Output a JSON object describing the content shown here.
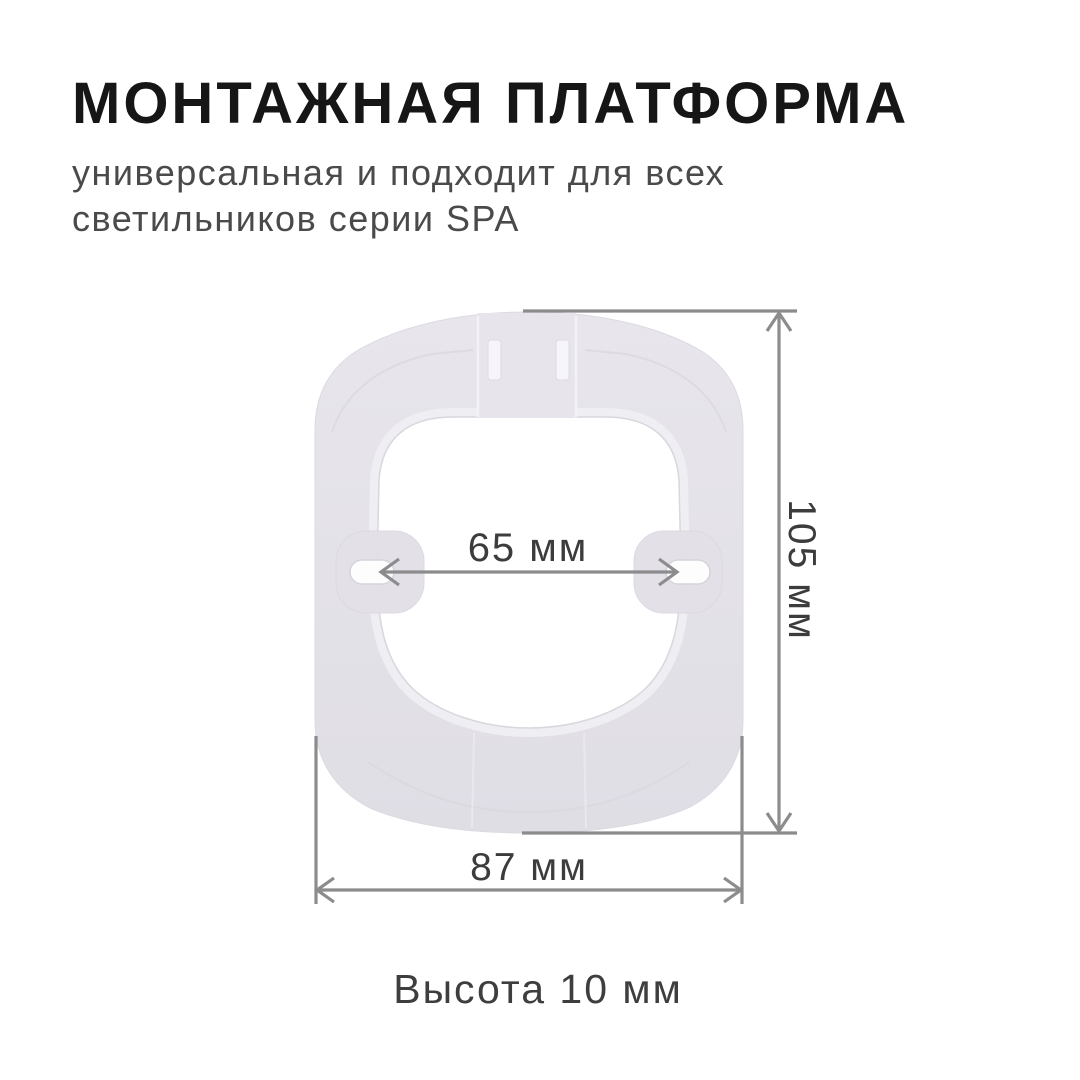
{
  "header": {
    "title": "МОНТАЖНАЯ ПЛАТФОРМА",
    "subtitle_line1": "универсальная и подходит для всех",
    "subtitle_line2": "светильников серии SPA"
  },
  "diagram": {
    "part_name": "mounting-platform",
    "dimensions": {
      "hole_spacing": "65 мм",
      "height": "105 мм",
      "width": "87 мм"
    },
    "height_note": "Высота 10 мм"
  },
  "colors": {
    "background": "#ffffff",
    "title_text": "#161616",
    "subtitle_text": "#4a4a4a",
    "platform_body": "#e4e2e8",
    "platform_body_light": "#e9e7ed",
    "platform_crease": "#d8d6dd",
    "platform_lip": "#efeef3",
    "hole_white": "#fdfdfe",
    "dimension_line": "#8c8c8e",
    "dimension_text": "#3c3c3c"
  }
}
